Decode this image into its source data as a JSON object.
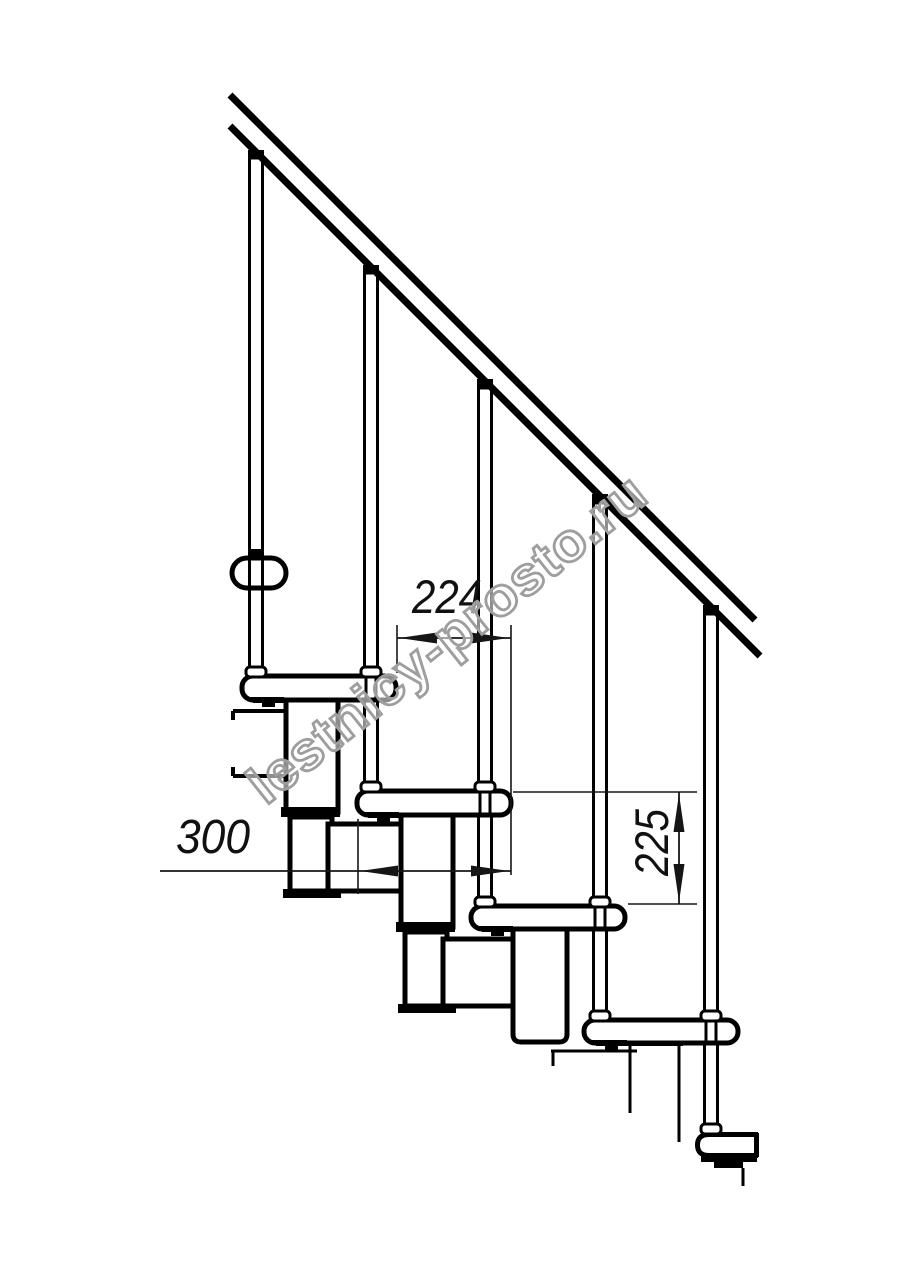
{
  "watermark": {
    "text": "lestnicy-prosto.ru"
  },
  "dimensions": {
    "step_run": {
      "label": "224"
    },
    "tread_depth": {
      "label": "300"
    },
    "step_height": {
      "label": "225"
    }
  },
  "colors": {
    "line": "#000000",
    "dimension": "#161616",
    "watermark_outline": "#9e9e9e",
    "background": "#ffffff"
  }
}
